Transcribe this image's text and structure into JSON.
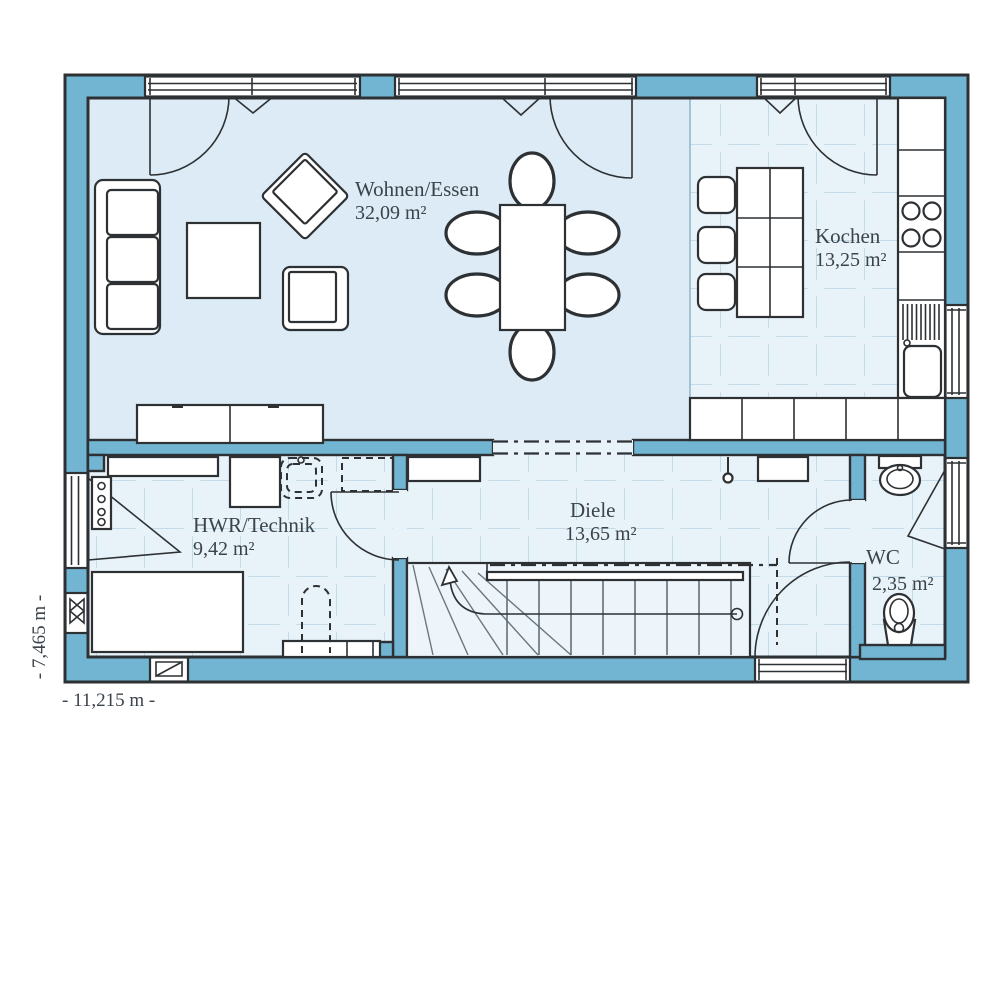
{
  "plan": {
    "rooms": [
      {
        "id": "wohnen-essen",
        "name": "Wohnen/Essen",
        "area": "32,09 m²"
      },
      {
        "id": "kochen",
        "name": "Kochen",
        "area": "13,25 m²"
      },
      {
        "id": "hwr-technik",
        "name": "HWR/Technik",
        "area": "9,42 m²"
      },
      {
        "id": "diele",
        "name": "Diele",
        "area": "13,65 m²"
      },
      {
        "id": "wc",
        "name": "WC",
        "area": "2,35 m²"
      }
    ],
    "dimensions": {
      "width_label": "- 11,215 m -",
      "height_label": "- 7,465 m -"
    },
    "colors": {
      "wall": "#72b5d2",
      "line": "#2d3134",
      "floor": "#dcebf5",
      "tilebg": "#e8f2f9",
      "tileline": "#c3dbe9",
      "stair": "#edf5fa",
      "text": "#3b434a"
    }
  }
}
